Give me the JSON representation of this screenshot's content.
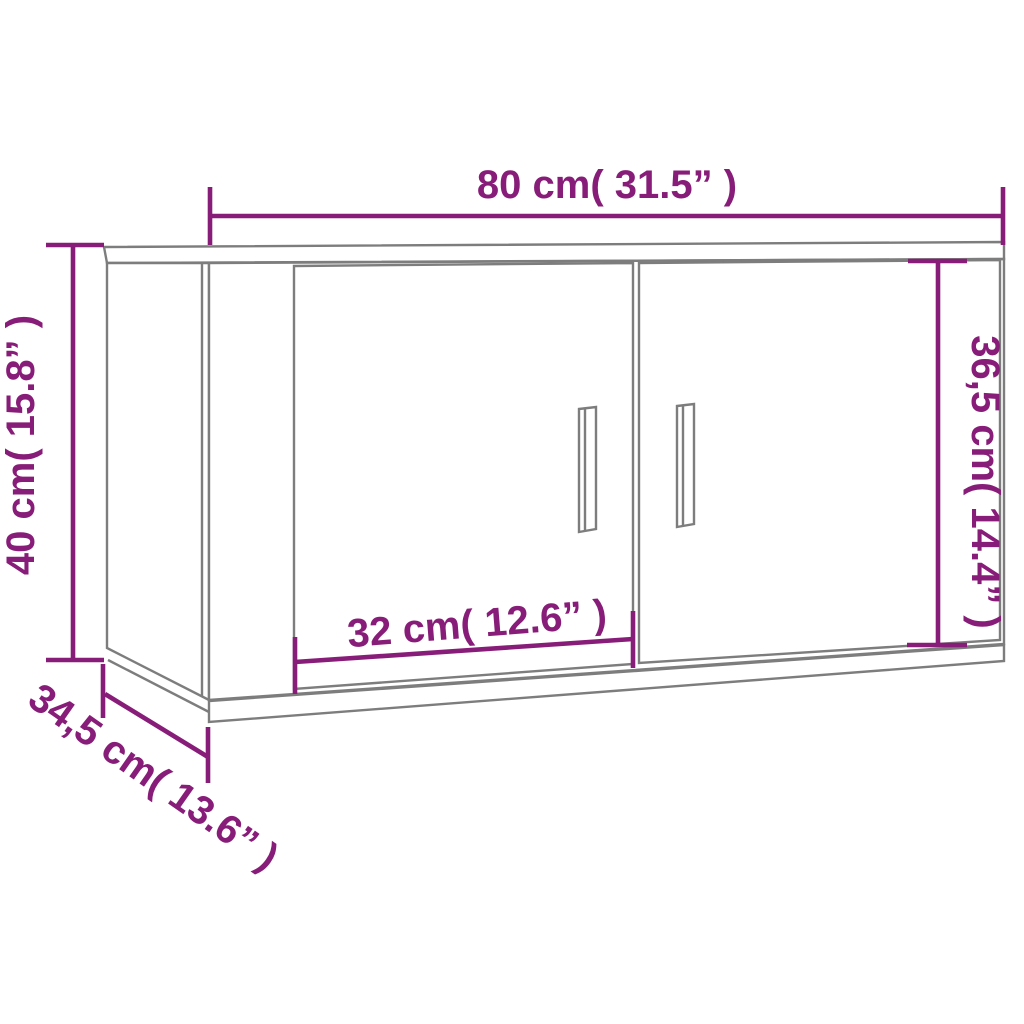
{
  "diagram": {
    "name": "wall-mounted-tv-cabinet-dimension-diagram",
    "colors": {
      "dimension_annotation": "#871d78",
      "cabinet_outline": "#7d7d7d",
      "background": "#ffffff"
    },
    "dimensions": {
      "width": {
        "label": "80 cm( 31.5” )",
        "cm": 80,
        "inches": 31.5
      },
      "height": {
        "label": "40 cm( 15.8” )",
        "cm": 40,
        "inches": 15.8
      },
      "inner_height": {
        "label": "36,5 cm( 14.4” )",
        "cm": 36.5,
        "inches": 14.4
      },
      "door_width": {
        "label": "32 cm( 12.6” )",
        "cm": 32,
        "inches": 12.6
      },
      "depth": {
        "label": "34,5 cm( 13.6” )",
        "cm": 34.5,
        "inches": 13.6
      }
    }
  }
}
